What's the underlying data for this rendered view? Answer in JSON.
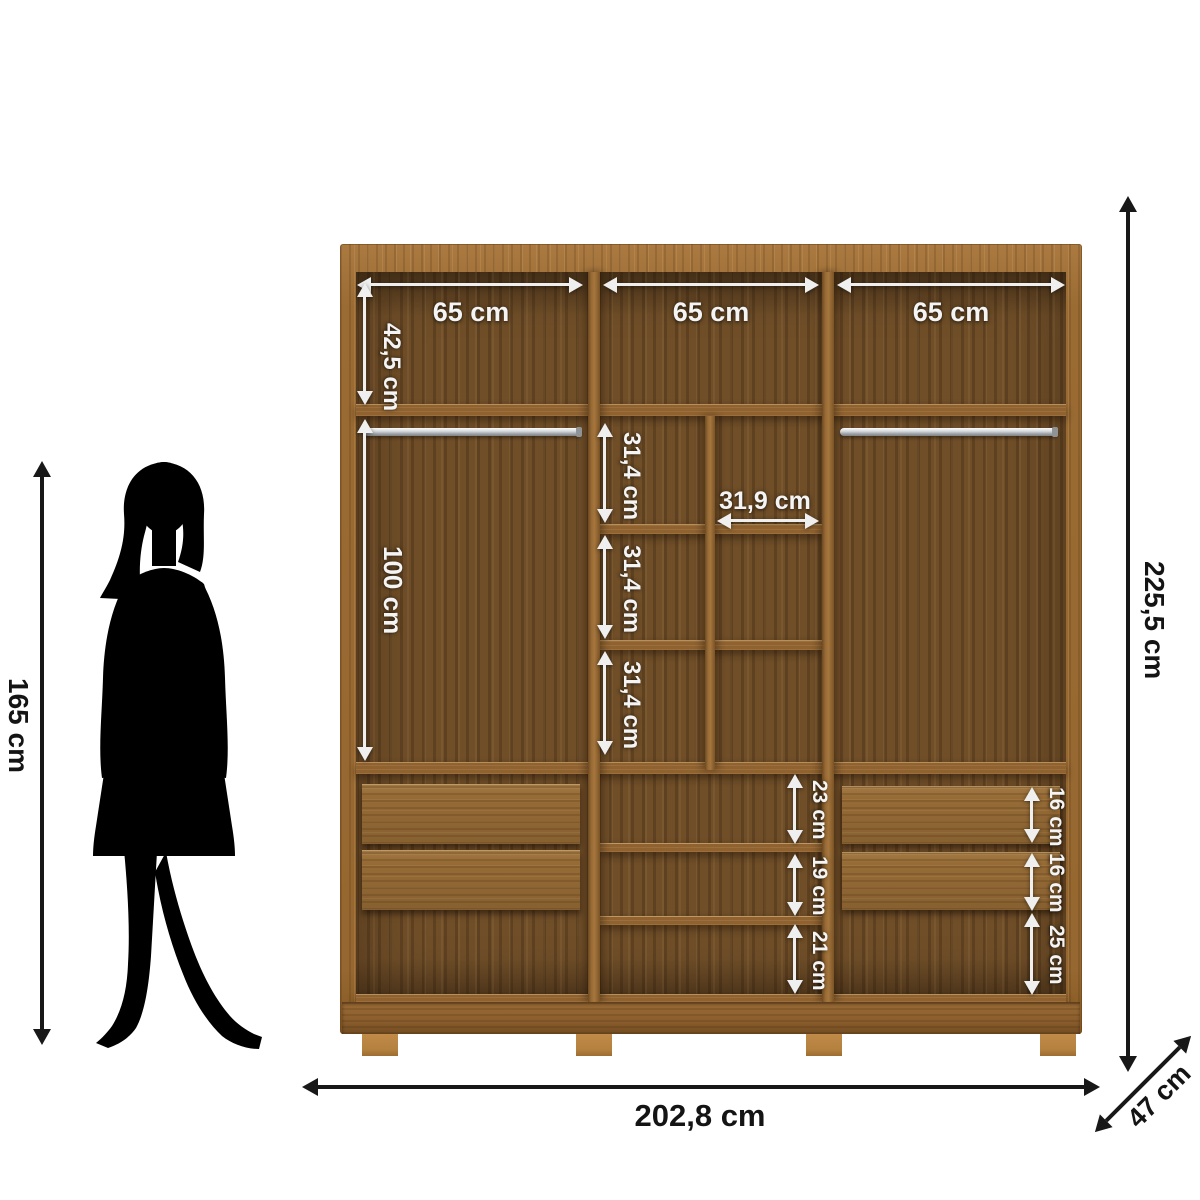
{
  "dimensions": {
    "section_widths": [
      "65 cm",
      "65 cm",
      "65 cm"
    ],
    "top_shelf_height": "42,5 cm",
    "hanging_height": "100 cm",
    "cubby_heights": [
      "31,4 cm",
      "31,4 cm",
      "31,4 cm"
    ],
    "cubby_width": "31,9 cm",
    "center_shelf_heights": [
      "23 cm",
      "19 cm",
      "21 cm"
    ],
    "right_drawer_heights": [
      "16 cm",
      "16 cm"
    ],
    "right_open_height": "25 cm",
    "overall_height": "225,5 cm",
    "overall_width": "202,8 cm",
    "overall_depth": "47 cm",
    "person_height": "165 cm"
  },
  "colors": {
    "background": "#ffffff",
    "wood_frame": "#9e6f38",
    "wood_interior": "#6f4e28",
    "wood_shelf": "#8f6230",
    "drawer_front": "#966b36",
    "foot": "#b5813f",
    "hanging_rod": "#d6d9dc",
    "inner_arrow": "#efefef",
    "outer_arrow": "#181818",
    "silhouette": "#000000"
  }
}
